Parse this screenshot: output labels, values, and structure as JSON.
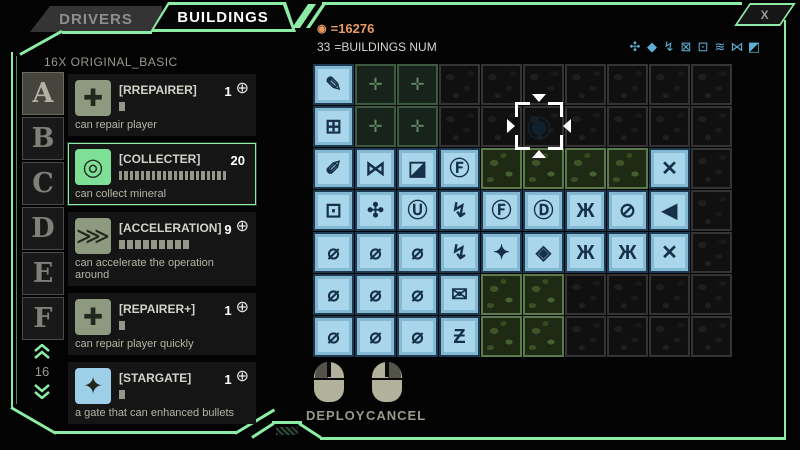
{
  "colors": {
    "accent_green": "#8ceca6",
    "currency_orange": "#e89b62",
    "tile_blue": "#a9d6ea"
  },
  "window": {
    "close_label": "X"
  },
  "tabs": {
    "drivers": "DRIVERS",
    "buildings": "BUILDINGS"
  },
  "left_panel": {
    "header": "16X ORIGINAL_BASIC",
    "letters": [
      "A",
      "B",
      "C",
      "D",
      "E",
      "F"
    ],
    "active_letter": "A",
    "scroll_value": "16",
    "items": [
      {
        "icon": "repairer-icon",
        "glyph": "✚",
        "icon_bg": "#8e9a80",
        "name": "[RREPAIRER]",
        "count": "1",
        "has_add": true,
        "segments": 1,
        "desc": "can repair player",
        "selected": false
      },
      {
        "icon": "collecter-icon",
        "glyph": "◎",
        "icon_bg": "#7ee096",
        "name": "[COLLECTER]",
        "count": "20",
        "has_add": false,
        "segments": 20,
        "desc": "can collect mineral",
        "selected": true
      },
      {
        "icon": "acceleration-icon",
        "glyph": "⋙",
        "icon_bg": "#8e9a80",
        "name": "[ACCELERATION]",
        "count": "9",
        "has_add": true,
        "segments": 9,
        "desc": "can accelerate the operation around",
        "selected": false
      },
      {
        "icon": "repairer-plus-icon",
        "glyph": "✚",
        "icon_bg": "#8e9a80",
        "name": "[REPAIRER+]",
        "count": "1",
        "has_add": true,
        "segments": 1,
        "desc": "can repair player quickly",
        "selected": false
      },
      {
        "icon": "stargate-icon",
        "glyph": "✦",
        "icon_bg": "#9ecfe8",
        "name": "[STARGATE]",
        "count": "1",
        "has_add": true,
        "segments": 1,
        "desc": "a gate that can enhanced bullets",
        "selected": false
      }
    ],
    "add_glyph": "⊕"
  },
  "right_panel": {
    "currency": {
      "icon": "◉",
      "value": "=16276"
    },
    "buildings_num": {
      "count": "33",
      "label": "=BUILDINGS NUM"
    },
    "mini_icons": [
      {
        "icon": "gear-icon",
        "glyph": "✣"
      },
      {
        "icon": "diamond-icon",
        "glyph": "◆"
      },
      {
        "icon": "bolt-icon",
        "glyph": "↯"
      },
      {
        "icon": "grid-icon",
        "glyph": "⊠"
      },
      {
        "icon": "box-icon",
        "glyph": "⊡"
      },
      {
        "icon": "waves-icon",
        "glyph": "≋"
      },
      {
        "icon": "hourglass-icon",
        "glyph": "⋈"
      },
      {
        "icon": "tiles-icon",
        "glyph": "◩"
      }
    ],
    "deploy_label": "DEPLOY",
    "cancel_label": "CANCEL"
  },
  "cursor": {
    "ghost_glyph": "◉"
  },
  "grid": {
    "cols": 10,
    "rows": 7,
    "legend": {
      "blue": "building-tile",
      "arrow": "spawner-tile",
      "dark": "rock-tile",
      "moss": "mineral-tile"
    },
    "cells": [
      [
        {
          "t": "blue",
          "g": "✎"
        },
        {
          "t": "arrow",
          "g": "✛"
        },
        {
          "t": "arrow",
          "g": "✛"
        },
        {
          "t": "dark"
        },
        {
          "t": "dark"
        },
        {
          "t": "dark"
        },
        {
          "t": "dark"
        },
        {
          "t": "dark"
        },
        {
          "t": "dark"
        },
        {
          "t": "dark"
        }
      ],
      [
        {
          "t": "blue",
          "g": "⊞"
        },
        {
          "t": "arrow",
          "g": "✛"
        },
        {
          "t": "arrow",
          "g": "✛"
        },
        {
          "t": "dark"
        },
        {
          "t": "dark"
        },
        {
          "t": "dark"
        },
        {
          "t": "dark"
        },
        {
          "t": "dark"
        },
        {
          "t": "dark"
        },
        {
          "t": "dark"
        }
      ],
      [
        {
          "t": "blue",
          "g": "✐"
        },
        {
          "t": "blue",
          "g": "⋈"
        },
        {
          "t": "blue",
          "g": "◪"
        },
        {
          "t": "blue",
          "g": "Ⓕ"
        },
        {
          "t": "moss"
        },
        {
          "t": "moss"
        },
        {
          "t": "moss"
        },
        {
          "t": "moss"
        },
        {
          "t": "blue",
          "g": "✕"
        },
        {
          "t": "dark"
        }
      ],
      [
        {
          "t": "blue",
          "g": "⊡"
        },
        {
          "t": "blue",
          "g": "✣"
        },
        {
          "t": "blue",
          "g": "Ⓤ"
        },
        {
          "t": "blue",
          "g": "↯"
        },
        {
          "t": "blue",
          "g": "Ⓕ"
        },
        {
          "t": "blue",
          "g": "Ⓓ"
        },
        {
          "t": "blue",
          "g": "Ж"
        },
        {
          "t": "blue",
          "g": "⊘"
        },
        {
          "t": "blue",
          "g": "◀"
        },
        {
          "t": "dark"
        }
      ],
      [
        {
          "t": "blue",
          "g": "⌀"
        },
        {
          "t": "blue",
          "g": "⌀"
        },
        {
          "t": "blue",
          "g": "⌀"
        },
        {
          "t": "blue",
          "g": "↯"
        },
        {
          "t": "blue",
          "g": "✦"
        },
        {
          "t": "blue",
          "g": "◈"
        },
        {
          "t": "blue",
          "g": "Ж"
        },
        {
          "t": "blue",
          "g": "Ж"
        },
        {
          "t": "blue",
          "g": "✕"
        },
        {
          "t": "dark"
        }
      ],
      [
        {
          "t": "blue",
          "g": "⌀"
        },
        {
          "t": "blue",
          "g": "⌀"
        },
        {
          "t": "blue",
          "g": "⌀"
        },
        {
          "t": "blue",
          "g": "✉"
        },
        {
          "t": "moss"
        },
        {
          "t": "moss"
        },
        {
          "t": "dark"
        },
        {
          "t": "dark"
        },
        {
          "t": "dark"
        },
        {
          "t": "dark"
        }
      ],
      [
        {
          "t": "blue",
          "g": "⌀"
        },
        {
          "t": "blue",
          "g": "⌀"
        },
        {
          "t": "blue",
          "g": "⌀"
        },
        {
          "t": "blue",
          "g": "Ƶ"
        },
        {
          "t": "moss"
        },
        {
          "t": "moss"
        },
        {
          "t": "dark"
        },
        {
          "t": "dark"
        },
        {
          "t": "dark"
        },
        {
          "t": "dark"
        }
      ]
    ]
  }
}
